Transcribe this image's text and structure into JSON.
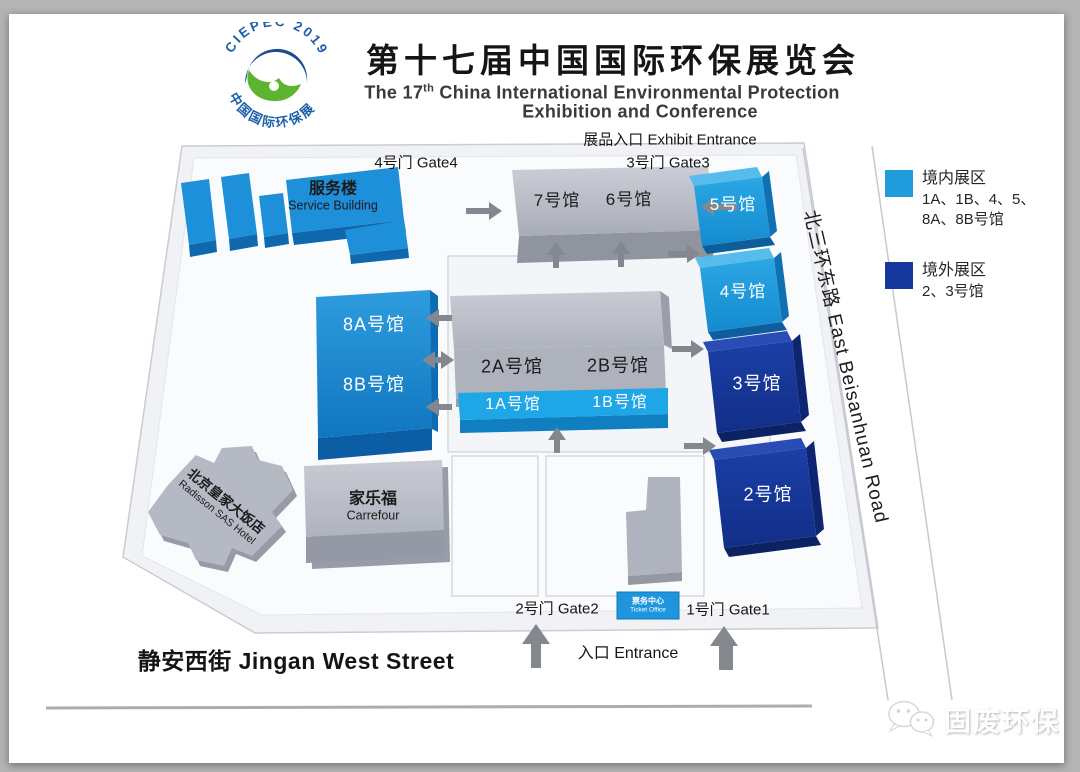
{
  "header": {
    "logo": {
      "arc_top": "CIEPEC 2019",
      "arc_bottom": "中国国际环保展"
    },
    "title_cn": "第十七届中国国际环保展览会",
    "subtitle": {
      "prefix": "The 17",
      "sup": "th",
      "rest": " China International Environmental Protection",
      "line2": "Exhibition and Conference"
    }
  },
  "map": {
    "entrances": {
      "exhibit_entrance": "展品入口 Exhibit Entrance",
      "gate4": "4号门 Gate4",
      "gate3": "3号门 Gate3",
      "gate2": "2号门 Gate2",
      "gate1": "1号门 Gate1",
      "entrance": "入口 Entrance"
    },
    "halls": {
      "h7": "7号馆",
      "h6": "6号馆",
      "h5": "5号馆",
      "h4": "4号馆",
      "h3": "3号馆",
      "h2": "2号馆",
      "h8a": "8A号馆",
      "h8b": "8B号馆",
      "h2a": "2A号馆",
      "h2b": "2B号馆",
      "h1a": "1A号馆",
      "h1b": "1B号馆"
    },
    "buildings": {
      "service_cn": "服务楼",
      "service_en": "Service Building",
      "hotel_cn": "北京皇家大饭店",
      "hotel_en": "Radisson SAS Hotel",
      "carrefour_cn": "家乐福",
      "carrefour_en": "Carrefour",
      "ticket_cn": "票务中心",
      "ticket_en": "Ticket Office"
    },
    "streets": {
      "south": "静安西街  Jingan West Street",
      "east": "北三环东路 East Beisanhuan Road"
    }
  },
  "legend": {
    "domestic": {
      "label": "境内展区",
      "line1": "1A、1B、4、5、",
      "line2": "8A、8B号馆",
      "color": "#209BDC"
    },
    "overseas": {
      "label": "境外展区",
      "line1": "2、3号馆",
      "color": "#16379B"
    }
  },
  "watermark": {
    "text": "固废环保"
  },
  "colors": {
    "hall_domestic": "#209BDC",
    "hall_overseas": "#16379B",
    "building_gray": "#B6BAC4",
    "arrow_gray": "#83878E",
    "logo_blue": "#1C5FA8",
    "logo_green": "#5CB431"
  }
}
